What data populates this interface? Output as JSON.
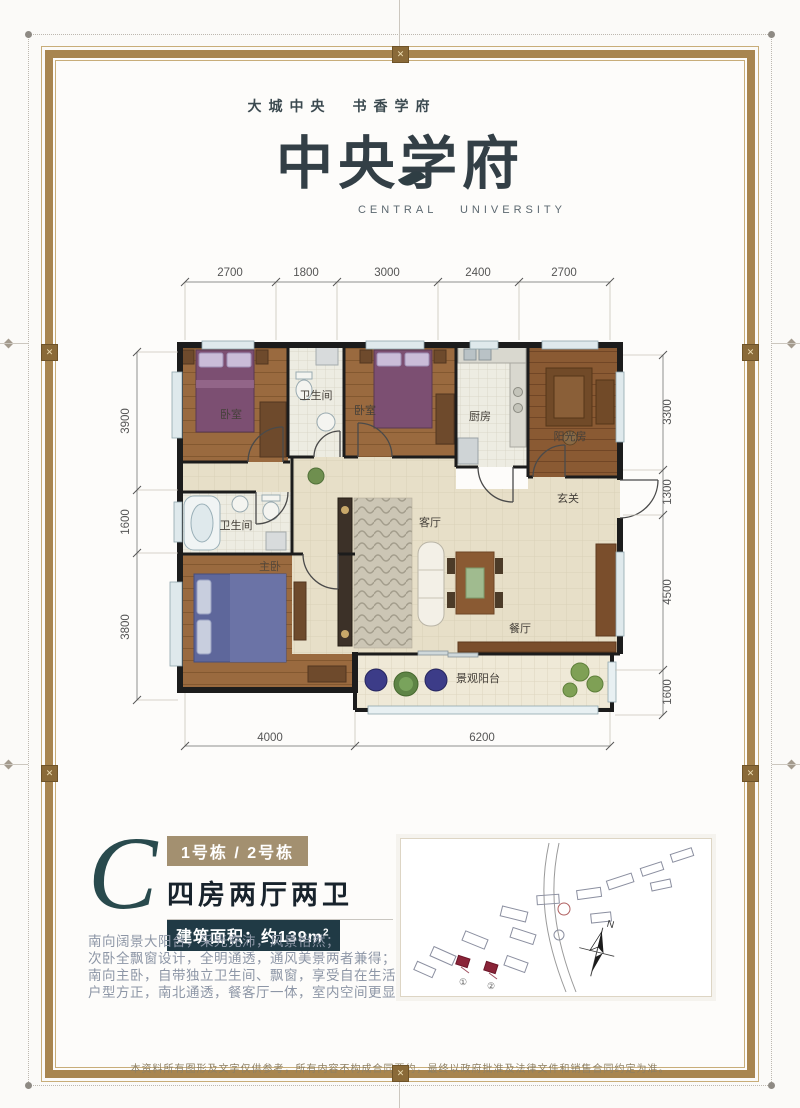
{
  "header": {
    "tagline": "大城中央　书香学府",
    "title": "中央学府",
    "subtitle": "CENTRAL  UNIVERSITY"
  },
  "plan": {
    "dims_top": [
      "2700",
      "1800",
      "3000",
      "2400",
      "2700"
    ],
    "dims_left": [
      "3900",
      "1600",
      "3800"
    ],
    "dims_right": [
      "3300",
      "1300",
      "4500",
      "1600"
    ],
    "dims_bottom": [
      "4000",
      "6200"
    ],
    "rooms": {
      "bedroom1": "卧室",
      "bath1": "卫生间",
      "bedroom2": "卧室",
      "kitchen": "厨房",
      "sunroom": "阳光房",
      "entry": "玄关",
      "bath2": "卫生间",
      "master": "主卧",
      "living": "客厅",
      "dining": "餐厅",
      "balcony": "景观阳台"
    }
  },
  "unit": {
    "letter": "C",
    "badge": "1号栋 / 2号栋",
    "layout": "四房两厅两卫",
    "area_text": "建筑面积：约139m",
    "area_sup": "2"
  },
  "description": {
    "line1": "南向阔景大阳台，采光充沛，风景怡然；",
    "line2": "次卧全飘窗设计，全明通透，通风美景两者兼得；",
    "line3": "南向主卧，自带独立卫生间、飘窗，享受自在生活；",
    "line4": "户型方正，南北通透，餐客厅一体，室内空间更显敞阔。"
  },
  "siteplan": {
    "north_label": "N",
    "marker1": "①",
    "marker2": "②"
  },
  "footer": {
    "disclaimer": "本资料所有图形及文字仅供参考，所有内容不构成合同要约，最终以政府批准及法律文件和销售合同约定为准。"
  },
  "icons": {
    "ornament": "✕"
  },
  "colors": {
    "frame": "#a8854f",
    "accent_teal": "#294a4d",
    "badge_bg": "#a39070",
    "area_bar_bg": "#203a45",
    "wall": "#1c1c1c"
  }
}
